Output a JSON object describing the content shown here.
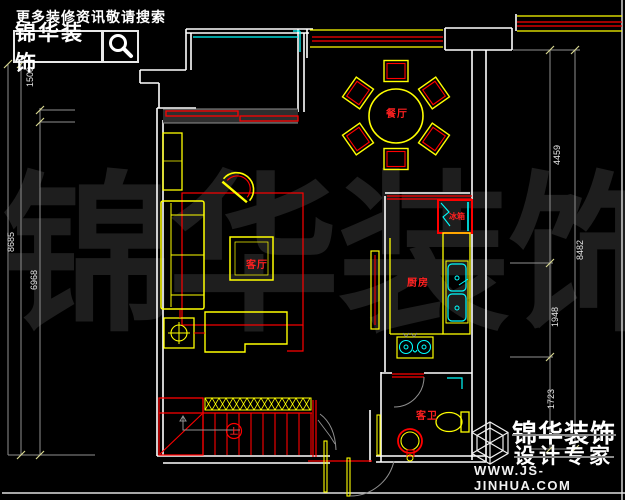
{
  "palette": {
    "background": "#000000",
    "walls": "#ffffff",
    "furniture_yellow": "#ffff00",
    "accent_red": "#ff0000",
    "window_cyan": "#00ffff",
    "dimension_gray": "#909090",
    "watermark_gray": "#1e1e1e"
  },
  "header": {
    "tagline": "更多装修资讯敬请搜索",
    "logo_text": "锦华装饰"
  },
  "watermark": {
    "chars": [
      "锦",
      "华",
      "装",
      "饰"
    ]
  },
  "plan": {
    "room_labels": {
      "dining": "餐厅",
      "living": "客厅",
      "kitchen": "厨房",
      "fridge": "冰箱",
      "guest_bath": "客卫"
    },
    "stair_up_label": "上"
  },
  "dimensions": {
    "left": [
      {
        "value": "1508"
      },
      {
        "value": "8685"
      },
      {
        "value": "6968"
      }
    ],
    "right": [
      {
        "value": "4459"
      },
      {
        "value": "8482"
      },
      {
        "value": "1948"
      },
      {
        "value": "1723"
      }
    ]
  },
  "footer": {
    "brand": "锦华装饰",
    "subtitle": "设计专家",
    "website": "WWW.JS-JINHUA.COM"
  }
}
